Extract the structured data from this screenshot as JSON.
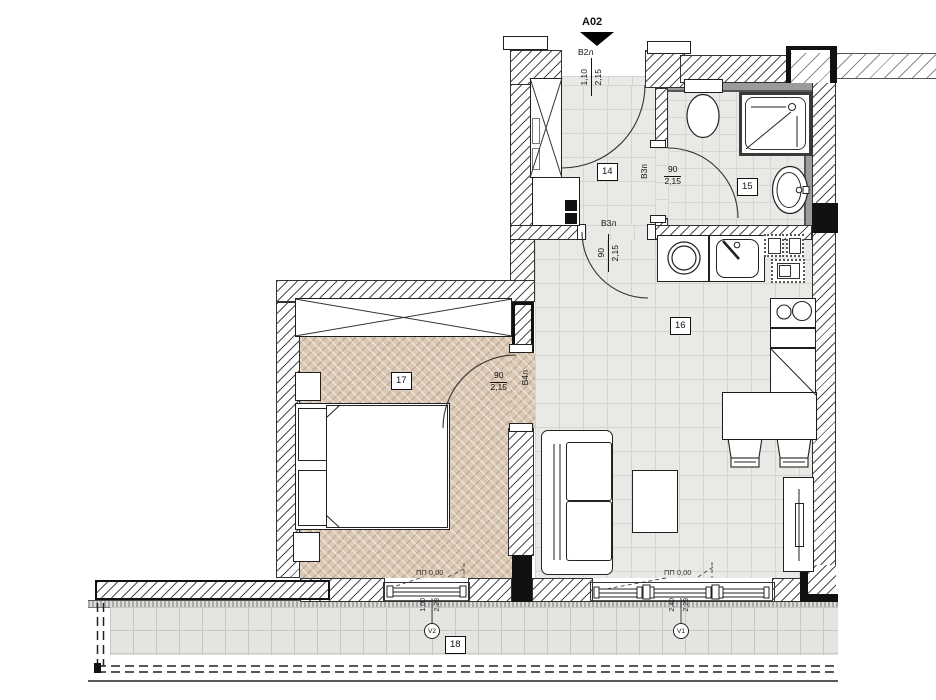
{
  "plan": {
    "section_marker": {
      "code": "A02"
    },
    "rooms": {
      "hall": {
        "number": "14"
      },
      "bathroom": {
        "number": "15"
      },
      "living": {
        "number": "16"
      },
      "bedroom": {
        "number": "17"
      },
      "terrace": {
        "number": "18"
      }
    },
    "doors": {
      "entrance": {
        "name": "В2л",
        "width": "1,10",
        "height": "2,15"
      },
      "bathroom": {
        "name": "В3п",
        "width": "90",
        "height": "2,15"
      },
      "living": {
        "name": "В3л",
        "width": "90",
        "height": "2,15"
      },
      "bedroom": {
        "name": "В4л",
        "width": "90",
        "height": "2,15"
      }
    },
    "windows": {
      "bedroom": {
        "name": "V2",
        "width": "1,00",
        "height": "2,29"
      },
      "living": {
        "name": "V1",
        "width": "2,40",
        "height": "2,29"
      }
    },
    "levels": {
      "bedroom_mark": "ПП 0,00",
      "living_mark": "ПП 0,00"
    },
    "colors": {
      "wood_floor": "#dbc9b6",
      "tile_floor": "#e9e9e6",
      "wall_black": "#111111"
    }
  }
}
